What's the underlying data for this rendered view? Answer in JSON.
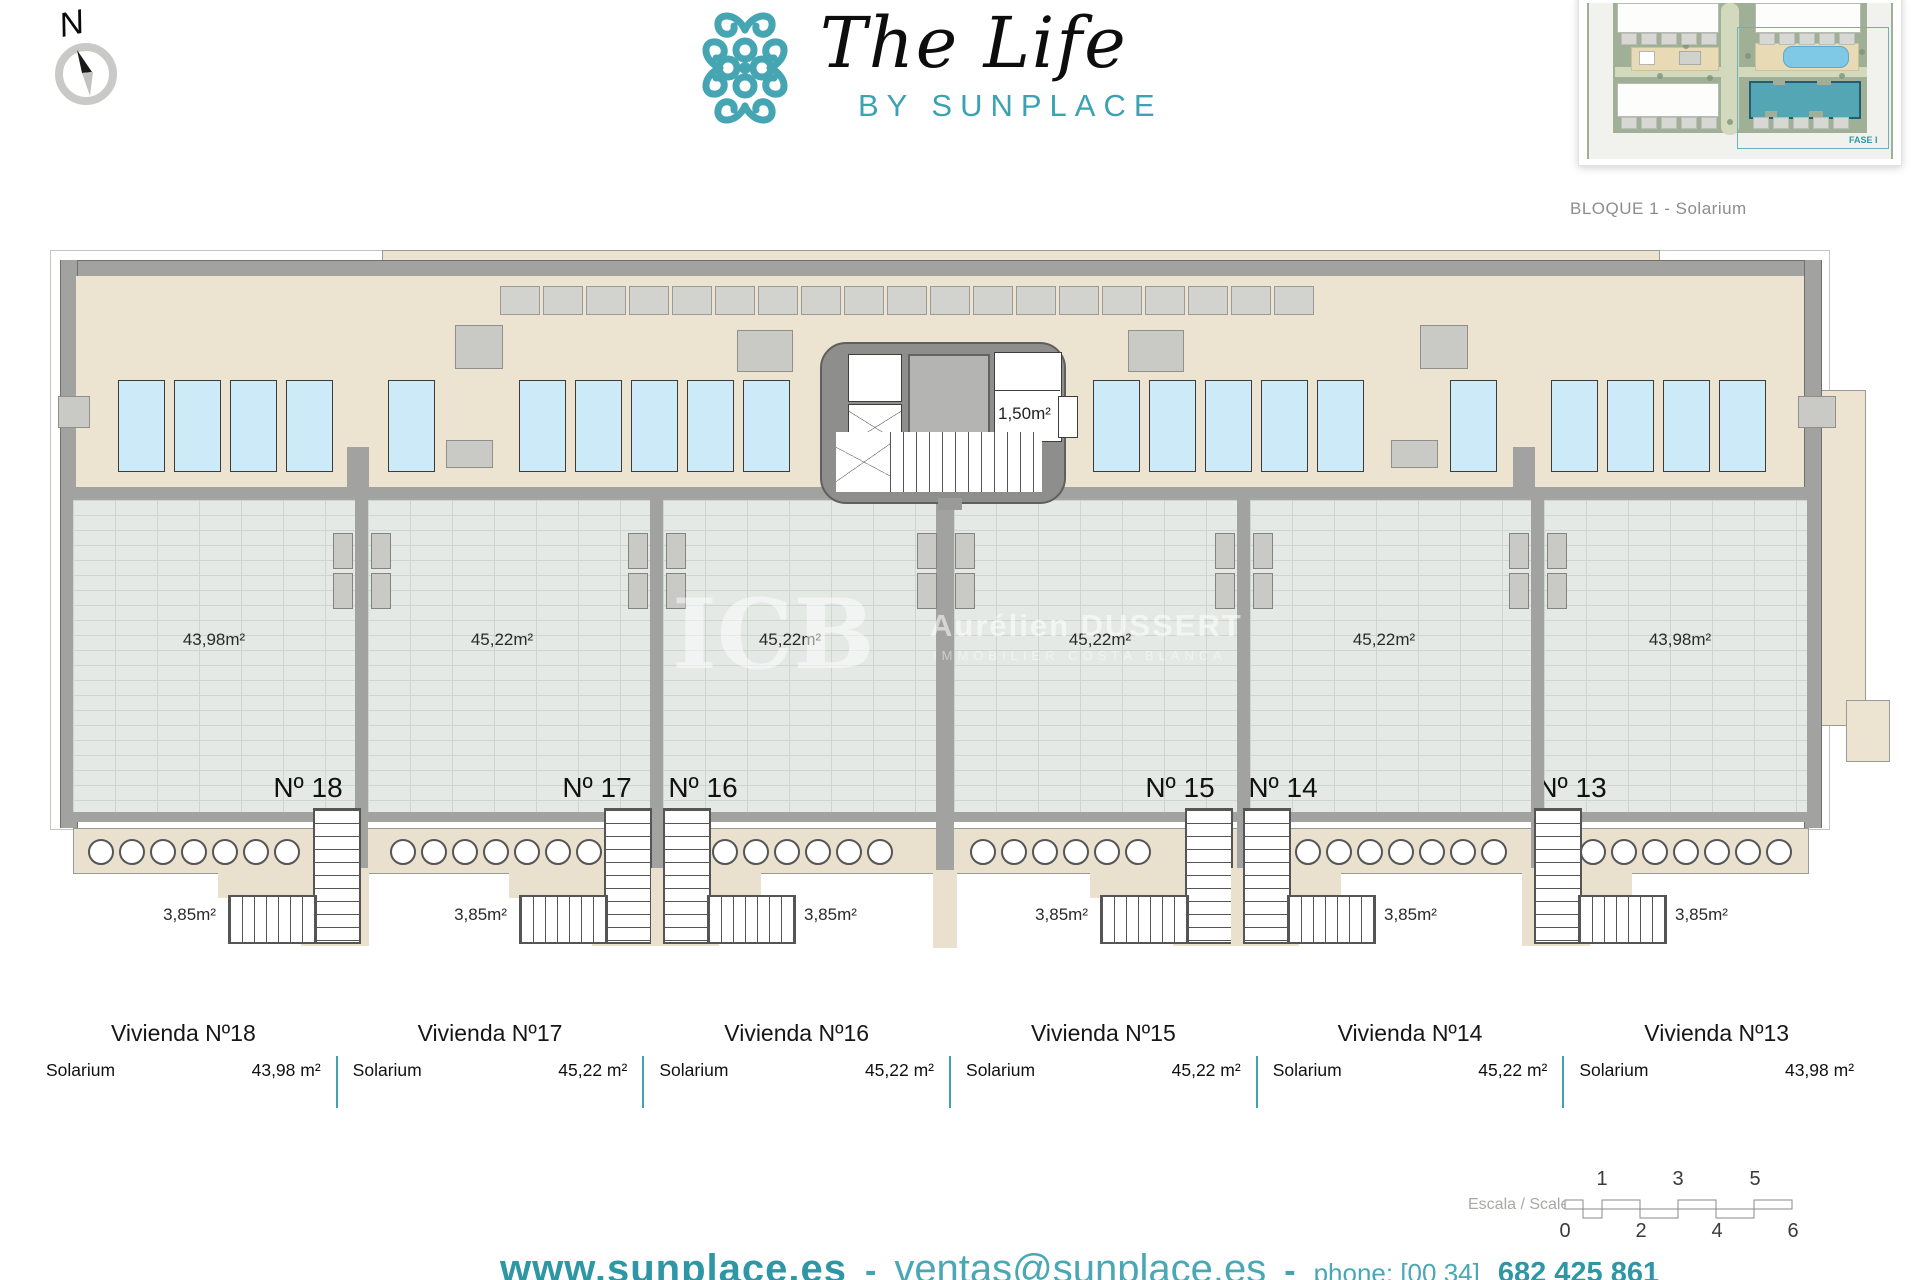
{
  "header": {
    "brand_title": "The Life",
    "brand_subtitle": "BY SUNPLACE"
  },
  "compass": {
    "label": "N"
  },
  "inset": {
    "caption": "BLOQUE 1 - Solarium",
    "fase_label": "FASE I"
  },
  "core": {
    "area_label": "1,50m²"
  },
  "watermark": {
    "initials": "ICB",
    "name": "Aurélien DUSSERT",
    "tagline": "IMMOBILIER COSTA BLANCA"
  },
  "units": [
    {
      "id": "18",
      "plan_number": "Nº 18",
      "plan_area": "43,98m²",
      "stair_area": "3,85m²",
      "table_title": "Vivienda Nº18",
      "table_row_label": "Solarium",
      "table_row_value": "43,98 m²"
    },
    {
      "id": "17",
      "plan_number": "Nº 17",
      "plan_area": "45,22m²",
      "stair_area": "3,85m²",
      "table_title": "Vivienda Nº17",
      "table_row_label": "Solarium",
      "table_row_value": "45,22 m²"
    },
    {
      "id": "16",
      "plan_number": "Nº 16",
      "plan_area": "45,22m²",
      "stair_area": "3,85m²",
      "table_title": "Vivienda Nº16",
      "table_row_label": "Solarium",
      "table_row_value": "45,22 m²"
    },
    {
      "id": "15",
      "plan_number": "Nº 15",
      "plan_area": "45,22m²",
      "stair_area": "3,85m²",
      "table_title": "Vivienda Nº15",
      "table_row_label": "Solarium",
      "table_row_value": "45,22 m²"
    },
    {
      "id": "14",
      "plan_number": "Nº 14",
      "plan_area": "45,22m²",
      "stair_area": "3,85m²",
      "table_title": "Vivienda Nº14",
      "table_row_label": "Solarium",
      "table_row_value": "45,22 m²"
    },
    {
      "id": "13",
      "plan_number": "Nº 13",
      "plan_area": "43,98m²",
      "stair_area": "3,85m²",
      "table_title": "Vivienda Nº13",
      "table_row_label": "Solarium",
      "table_row_value": "43,98 m²"
    }
  ],
  "scalebar": {
    "label": "Escala / Scale",
    "top_ticks": [
      "1",
      "3",
      "5"
    ],
    "bottom_ticks": [
      "0",
      "2",
      "4",
      "6"
    ]
  },
  "footer": {
    "website": "www.sunplace.es",
    "separator1": "-",
    "email": "ventas@sunplace.es",
    "separator2": "-",
    "phone_label": "phone: [00 34]",
    "phone_number": "682 425 861"
  },
  "colors": {
    "accent_teal": "#3fa3b1",
    "roof_beige": "#ece3d1",
    "panel_blue": "#cdeaf8",
    "wall_gray": "#a2a2a0",
    "tile_gray": "#e4e9e6",
    "highlight_building": "#54a6b5"
  }
}
